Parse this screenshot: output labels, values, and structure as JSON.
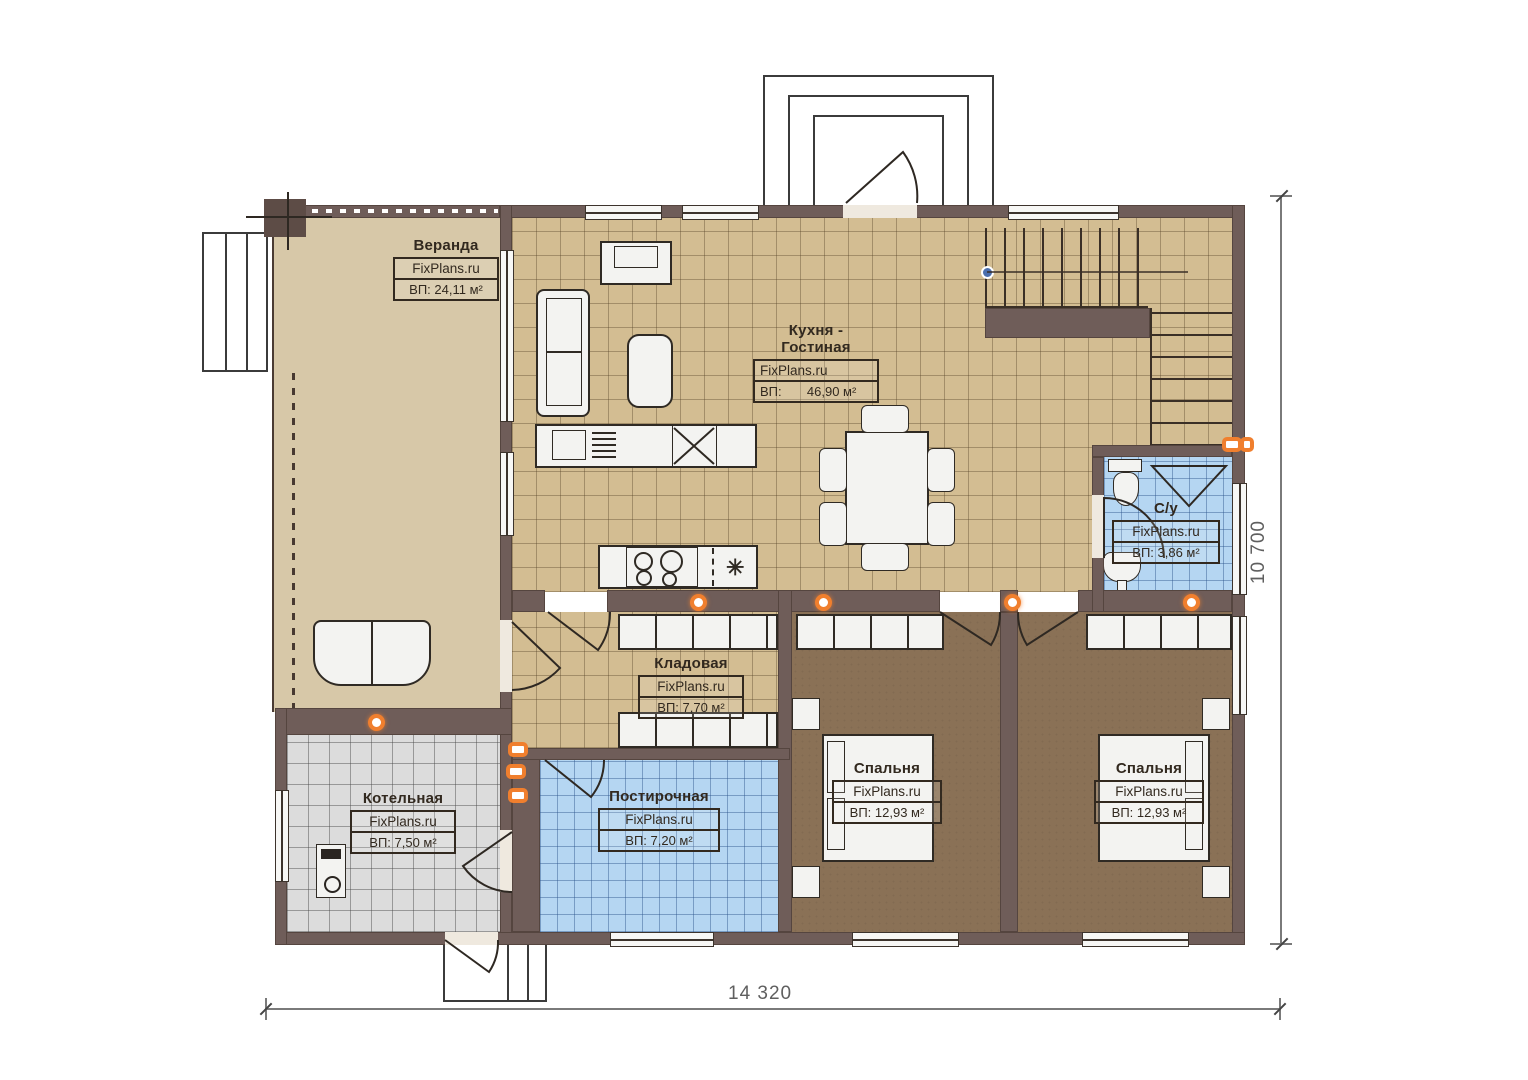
{
  "brand": "FixPlans.ru",
  "rooms": [
    {
      "name": "Веранда",
      "watermark": "FixPlans.ru",
      "area": "ВП: 24,11 м²"
    },
    {
      "name": "Кухня - Гостиная",
      "watermark": "FixPlans.ru",
      "area": "ВП:       46,90 м²"
    },
    {
      "name": "С/у",
      "watermark": "FixPlans.ru",
      "area": "ВП: 3,86 м²"
    },
    {
      "name": "Кладовая",
      "watermark": "FixPlans.ru",
      "area": "ВП: 7,70 м²"
    },
    {
      "name": "Котельная",
      "watermark": "FixPlans.ru",
      "area": "ВП: 7,50 м²"
    },
    {
      "name": "Постирочная",
      "watermark": "FixPlans.ru",
      "area": "ВП: 7,20 м²"
    },
    {
      "name": "Спальня",
      "watermark": "FixPlans.ru",
      "area": "ВП: 12,93 м²"
    },
    {
      "name": "Спальня",
      "watermark": "FixPlans.ru",
      "area": "ВП: 12,93 м²"
    }
  ],
  "dimensions": {
    "bottom": "14 320",
    "right": "10 700"
  },
  "icons": {
    "freezer": "✳"
  },
  "colors": {
    "wall": "#6f5d59",
    "veranda_floor": "#d7c8a8",
    "kitchen_tile": "#d3bd92",
    "bedroom_floor": "#8a7156",
    "wet_room_tile": "#b5d6f2",
    "boiler_tile": "#dcdcdc",
    "lamp_accent": "#f07f2e"
  }
}
